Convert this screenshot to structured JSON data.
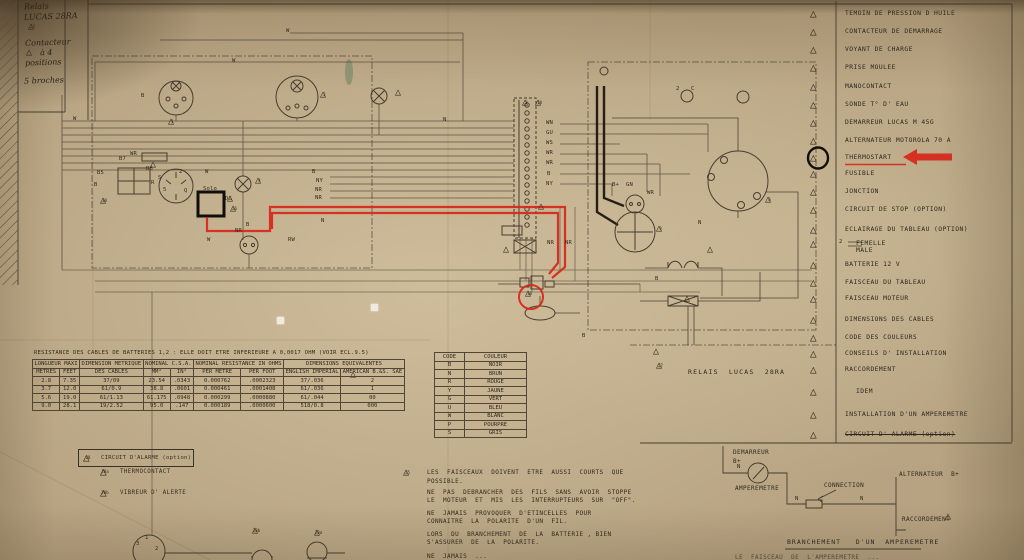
{
  "colors": {
    "paper": "#b7a381",
    "ink": "#3a3126",
    "red": "#d7271b",
    "marker_black": "#120e0a"
  },
  "handwritten": {
    "l1": "Relais",
    "l2": "LUCAS 28RA",
    "tri1": "23",
    "l3": "Contacteur",
    "l4": "à 4",
    "l5": "positions",
    "l6": "5 broches"
  },
  "legend": {
    "items": [
      {
        "y": 8,
        "num": "",
        "label": "TEMOIN  DE  PRESSION  D  HUILE"
      },
      {
        "y": 26,
        "num": "",
        "label": "CONTACTEUR DE  DEMARRAGE"
      },
      {
        "y": 44,
        "num": "",
        "label": "VOYANT  DE  CHARGE"
      },
      {
        "y": 62,
        "num": "",
        "label": "PRISE  MOULEE"
      },
      {
        "y": 81,
        "num": "",
        "label": "MANOCONTACT"
      },
      {
        "y": 99,
        "num": "",
        "label": "SONDE  T°  D' EAU"
      },
      {
        "y": 117,
        "num": "",
        "label": "DEMARREUR  LUCAS  M 45G"
      },
      {
        "y": 135,
        "num": "",
        "label": "ALTERNATEUR  MOTOROLA  70 A"
      },
      {
        "y": 152,
        "num": "",
        "label": "THERMOSTART"
      },
      {
        "y": 168,
        "num": "",
        "label": "FUSIBLE"
      },
      {
        "y": 186,
        "num": "",
        "label": "JONCTION"
      },
      {
        "y": 204,
        "num": "",
        "label": "CIRCUIT  DE STOP    (OPTION)"
      },
      {
        "y": 224,
        "num": "",
        "label": "ECLAIRAGE  DU TABLEAU (OPTION)"
      },
      {
        "y": 238,
        "num": "",
        "label": "FEMELLE\nMALE",
        "cls": "two"
      },
      {
        "y": 259,
        "num": "",
        "label": "BATTERIE  12 V"
      },
      {
        "y": 277,
        "num": "",
        "label": "FAISCEAU  DU TABLEAU"
      },
      {
        "y": 293,
        "num": "",
        "label": "FAISCEAU MOTEUR"
      },
      {
        "y": 314,
        "num": "",
        "label": "DIMENSIONS DES CABLES"
      },
      {
        "y": 332,
        "num": "",
        "label": "CODE  DES  COULEURS"
      },
      {
        "y": 348,
        "num": "",
        "label": "CONSEILS  D' INSTALLATION"
      },
      {
        "y": 364,
        "num": "",
        "label": "RACCORDEMENT"
      },
      {
        "y": 386,
        "num": "",
        "label": "IDEM",
        "cls": "indent"
      },
      {
        "y": 409,
        "num": "",
        "label": "INSTALLATION  D'UN AMPEREMETRE"
      },
      {
        "y": 429,
        "num": "",
        "label": "CIRCUIT  D' ALARME (option)",
        "cls": "struck"
      }
    ]
  },
  "schematic": {
    "relais_label": "RELAIS  LUCAS  28RA",
    "wire_labels": [
      {
        "t": "W",
        "x": 232,
        "y": 58
      },
      {
        "t": "W",
        "x": 286,
        "y": 28
      },
      {
        "t": "B",
        "x": 141,
        "y": 93
      },
      {
        "t": "WR",
        "x": 130,
        "y": 151
      },
      {
        "t": "B5",
        "x": 97,
        "y": 170
      },
      {
        "t": "B7",
        "x": 119,
        "y": 156
      },
      {
        "t": "B6",
        "x": 146,
        "y": 166
      },
      {
        "t": "B",
        "x": 94,
        "y": 182
      },
      {
        "t": "R",
        "x": 151,
        "y": 180
      },
      {
        "t": "2",
        "x": 179,
        "y": 169
      },
      {
        "t": "5",
        "x": 163,
        "y": 187
      },
      {
        "t": "Q",
        "x": 184,
        "y": 188
      },
      {
        "t": "S",
        "x": 158,
        "y": 175
      },
      {
        "t": "Solo",
        "x": 203,
        "y": 186
      },
      {
        "t": "DG",
        "x": 225,
        "y": 196
      },
      {
        "t": "W",
        "x": 205,
        "y": 169
      },
      {
        "t": "B",
        "x": 312,
        "y": 169
      },
      {
        "t": "NY",
        "x": 316,
        "y": 178
      },
      {
        "t": "NR",
        "x": 315,
        "y": 187
      },
      {
        "t": "NR",
        "x": 315,
        "y": 195
      },
      {
        "t": "N",
        "x": 321,
        "y": 218
      },
      {
        "t": "NR",
        "x": 235,
        "y": 228
      },
      {
        "t": "W",
        "x": 207,
        "y": 237
      },
      {
        "t": "RW",
        "x": 288,
        "y": 237
      },
      {
        "t": "N",
        "x": 443,
        "y": 117
      },
      {
        "t": "WN",
        "x": 546,
        "y": 120
      },
      {
        "t": "GU",
        "x": 546,
        "y": 130
      },
      {
        "t": "WS",
        "x": 546,
        "y": 140
      },
      {
        "t": "WR",
        "x": 546,
        "y": 150
      },
      {
        "t": "WR",
        "x": 546,
        "y": 160
      },
      {
        "t": "B",
        "x": 547,
        "y": 171
      },
      {
        "t": "NY",
        "x": 546,
        "y": 181
      },
      {
        "t": "NR",
        "x": 547,
        "y": 240
      },
      {
        "t": "NR",
        "x": 565,
        "y": 240
      },
      {
        "t": "B+",
        "x": 612,
        "y": 182
      },
      {
        "t": "GN",
        "x": 626,
        "y": 182
      },
      {
        "t": "WR",
        "x": 647,
        "y": 190
      },
      {
        "t": "N",
        "x": 698,
        "y": 220
      },
      {
        "t": "B",
        "x": 655,
        "y": 276
      },
      {
        "t": "B",
        "x": 582,
        "y": 333
      },
      {
        "t": "2",
        "x": 676,
        "y": 86
      },
      {
        "t": "C",
        "x": 691,
        "y": 86
      },
      {
        "t": "W",
        "x": 73,
        "y": 116
      },
      {
        "t": "B",
        "x": 246,
        "y": 222
      },
      {
        "t": "N",
        "x": 737,
        "y": 464
      },
      {
        "t": "N",
        "x": 795,
        "y": 496
      },
      {
        "t": "N",
        "x": 860,
        "y": 496
      },
      {
        "t": "3",
        "x": 136,
        "y": 541
      },
      {
        "t": "1",
        "x": 145,
        "y": 535
      },
      {
        "t": "2",
        "x": 155,
        "y": 546
      },
      {
        "t": "2",
        "x": 839,
        "y": 239
      }
    ],
    "triangles": [
      {
        "x": 168,
        "y": 117,
        "n": "1"
      },
      {
        "x": 320,
        "y": 90,
        "n": "2"
      },
      {
        "x": 395,
        "y": 88,
        "n": ""
      },
      {
        "x": 255,
        "y": 176,
        "n": "4"
      },
      {
        "x": 227,
        "y": 194,
        "n": ""
      },
      {
        "x": 230,
        "y": 204,
        "n": "26"
      },
      {
        "x": 100,
        "y": 196,
        "n": "30"
      },
      {
        "x": 150,
        "y": 160,
        "n": ""
      },
      {
        "x": 522,
        "y": 98,
        "n": "3"
      },
      {
        "x": 535,
        "y": 98,
        "n": "18"
      },
      {
        "x": 503,
        "y": 245,
        "n": ""
      },
      {
        "x": 525,
        "y": 289,
        "n": "10"
      },
      {
        "x": 656,
        "y": 224,
        "n": "9"
      },
      {
        "x": 765,
        "y": 195,
        "n": "8"
      },
      {
        "x": 707,
        "y": 245,
        "n": ""
      },
      {
        "x": 653,
        "y": 347,
        "n": ""
      },
      {
        "x": 656,
        "y": 361,
        "n": "27"
      },
      {
        "x": 350,
        "y": 370,
        "n": ""
      },
      {
        "x": 538,
        "y": 202,
        "n": ""
      },
      {
        "x": 684,
        "y": 294,
        "n": ""
      },
      {
        "x": 945,
        "y": 512,
        "n": ""
      },
      {
        "x": 403,
        "y": 468,
        "n": "25"
      },
      {
        "x": 252,
        "y": 526,
        "n": "28b"
      },
      {
        "x": 314,
        "y": 528,
        "n": "28a"
      }
    ]
  },
  "cable_table": {
    "title": "RESISTANCE DES CABLES DE BATTERIES 1,2 : ELLE DOIT ETRE INFERIEURE A 0,0017 OHM (VOIR ECL.9.5)",
    "group_headers": [
      "LONGUEUR MAXI",
      "DIMENSION METRIQUE",
      "NOMINAL C.S.A.",
      "NOMINAL RESISTANCE IN OHMS",
      "DIMENSIONS EQUIVALENTES"
    ],
    "col_headers": [
      "METRES",
      "FEET",
      "DES CABLES",
      "MM²",
      "IN²",
      "PER METRE",
      "PER FOOT",
      "ENGLISH IMPERIAL",
      "AMERICAN B.&S. SAE"
    ],
    "rows": [
      [
        "2.8",
        "7.35",
        "37/09",
        "23.54",
        ".0343",
        "0.000762",
        ".0002323",
        "37/.036",
        "2"
      ],
      [
        "3.7",
        "12.0",
        "61/0.9",
        "38.8",
        ".0601",
        "0.000461",
        ".0001408",
        "61/.036",
        "1"
      ],
      [
        "5.6",
        "19.0",
        "61/1.13",
        "61.175",
        ".0948",
        "0.000299",
        ".0000880",
        "61/.044",
        "00"
      ],
      [
        "9.0",
        "28.1",
        "19/2.52",
        "95.0",
        ".147",
        "0.000189",
        ".0000600",
        "518/0.8",
        "000"
      ]
    ]
  },
  "color_table": {
    "headers": [
      "CODE",
      "COULEUR"
    ],
    "rows": [
      [
        "B",
        "NOIR"
      ],
      [
        "N",
        "BRUN"
      ],
      [
        "R",
        "ROUGE"
      ],
      [
        "Y",
        "JAUNE"
      ],
      [
        "G",
        "VERT"
      ],
      [
        "U",
        "BLEU"
      ],
      [
        "W",
        "BLANC"
      ],
      [
        "P",
        "POURPRE"
      ],
      [
        "S",
        "GRIS"
      ]
    ]
  },
  "notes": {
    "lines": [
      {
        "y": 469,
        "text": "LES  FAISCEAUX  DOIVENT  ETRE  AUSSI  COURTS  QUE"
      },
      {
        "y": 478,
        "text": "POSSIBLE."
      },
      {
        "y": 489,
        "text": "NE  PAS  DEBRANCHER  DES  FILS  SANS  AVOIR  STOPPE"
      },
      {
        "y": 497,
        "text": "LE  MOTEUR  ET  MIS  LES  INTERRUPTEURS  SUR  \"OFF\"."
      },
      {
        "y": 510,
        "text": "NE  JAMAIS  PROVOQUER  D'ETINCELLES  POUR"
      },
      {
        "y": 518,
        "text": "CONNAITRE  LA  POLARITE  D'UN  FIL."
      },
      {
        "y": 531,
        "text": "LORS  DU  BRANCHEMENT  DE  LA  BATTERIE , BIEN"
      },
      {
        "y": 539,
        "text": "S'ASSURER  DE  LA  POLARITE."
      },
      {
        "y": 553,
        "text": "NE  JAMAIS  ..."
      }
    ]
  },
  "alarm": {
    "box_num": "28",
    "box_label": "CIRCUIT  D'ALARME (option)",
    "items": [
      {
        "y": 466,
        "num": "28a",
        "label": "THERMOCONTACT"
      },
      {
        "y": 487,
        "num": "28b",
        "label": "VIBREUR D' ALERTE"
      }
    ]
  },
  "inset": {
    "demarreur": "DEMARREUR",
    "bplus": "B+",
    "amperemetre": "AMPEREMETRE",
    "connection": "CONNECTION",
    "alternateur": "ALTERNATEUR  B+",
    "raccordement": "RACCORDEMENT",
    "title": "BRANCHEMENT   D'UN  AMPEREMETRE",
    "partial": "LE  FAISCEAU  DE  L'AMPEREMETRE  ..."
  }
}
